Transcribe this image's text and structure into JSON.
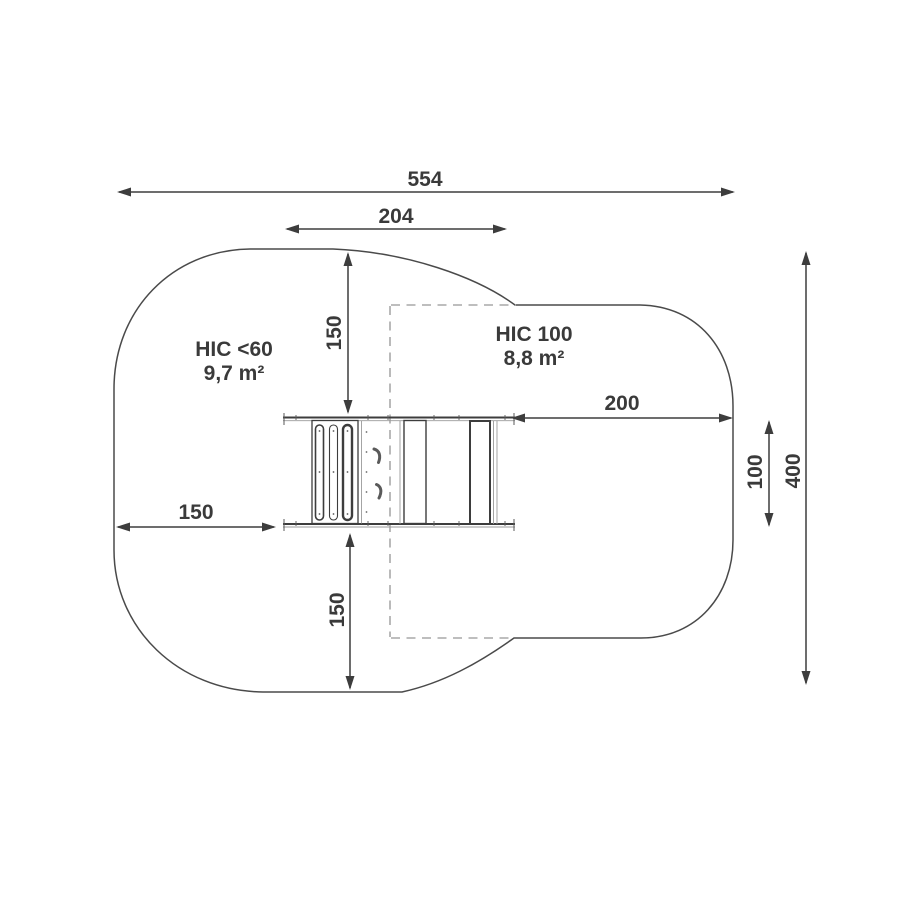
{
  "diagram": {
    "kind": "playground-safety-zone-plan",
    "dimensions": {
      "total_width": "554",
      "equipment_span": "204",
      "clearance_top": "150",
      "clearance_bottom": "150",
      "clearance_left": "150",
      "clearance_right": "200",
      "zone_right_height": "100",
      "total_height": "400"
    },
    "zones": {
      "left": {
        "label": "HIC <60",
        "area": "9,7 m²"
      },
      "right": {
        "label": "HIC 100",
        "area": "8,8 m²"
      }
    },
    "colors": {
      "line": "#3d3d3d",
      "dashed": "#a9a9a9",
      "text": "#3a3a3a",
      "background": "#ffffff"
    }
  }
}
